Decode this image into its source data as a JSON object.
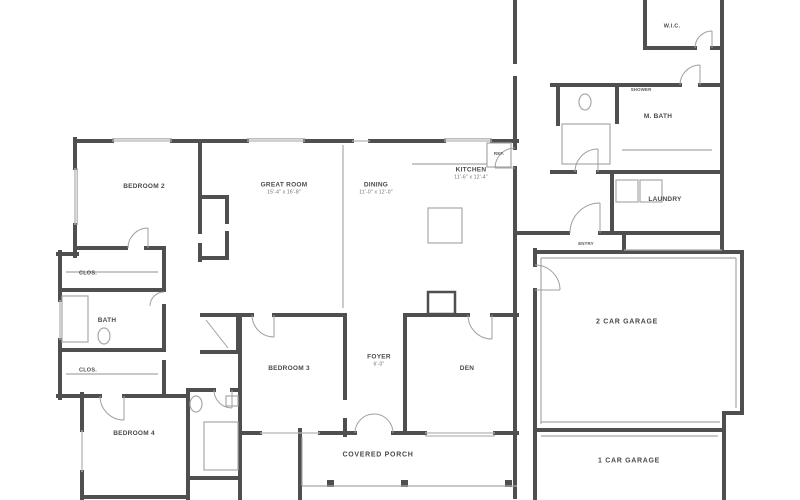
{
  "palette": {
    "wall": "#4f4f4f",
    "thin": "#a8a8a8",
    "win": "#b4b4b4",
    "door": "#9f9f9f",
    "label": "#4a4a4a",
    "dim": "#6e6e6e",
    "bg": "#ffffff"
  },
  "rooms": [
    {
      "id": "bedroom-2",
      "label": "BEDROOM 2"
    },
    {
      "id": "great-room",
      "label": "GREAT ROOM",
      "dims": "15'-4\" x 16'-8\""
    },
    {
      "id": "dining",
      "label": "DINING",
      "dims": "11'-0\" x 12'-0\""
    },
    {
      "id": "kitchen",
      "label": "KITCHEN",
      "dims": "11'-6\" x 12'-4\""
    },
    {
      "id": "bedroom-3",
      "label": "BEDROOM 3"
    },
    {
      "id": "foyer",
      "label": "FOYER",
      "dims": "6'-0\""
    },
    {
      "id": "den",
      "label": "DEN"
    },
    {
      "id": "covered-porch",
      "label": "COVERED PORCH"
    },
    {
      "id": "bedroom-4",
      "label": "BEDROOM 4"
    },
    {
      "id": "bath-2",
      "label": "BATH"
    },
    {
      "id": "closet-upper",
      "label": "CLOS."
    },
    {
      "id": "closet-lower",
      "label": "CLOS."
    },
    {
      "id": "garage-2-car",
      "label": "2 CAR GARAGE"
    },
    {
      "id": "garage-1-car",
      "label": "1 CAR GARAGE"
    },
    {
      "id": "walk-in-closet",
      "label": "W.I.C."
    },
    {
      "id": "master-bath",
      "label": "M. BATH"
    },
    {
      "id": "laundry",
      "label": "LAUNDRY"
    },
    {
      "id": "shower",
      "label": "SHOWER"
    },
    {
      "id": "entry",
      "label": "ENTRY"
    },
    {
      "id": "refrigerator",
      "label": "REF."
    }
  ]
}
